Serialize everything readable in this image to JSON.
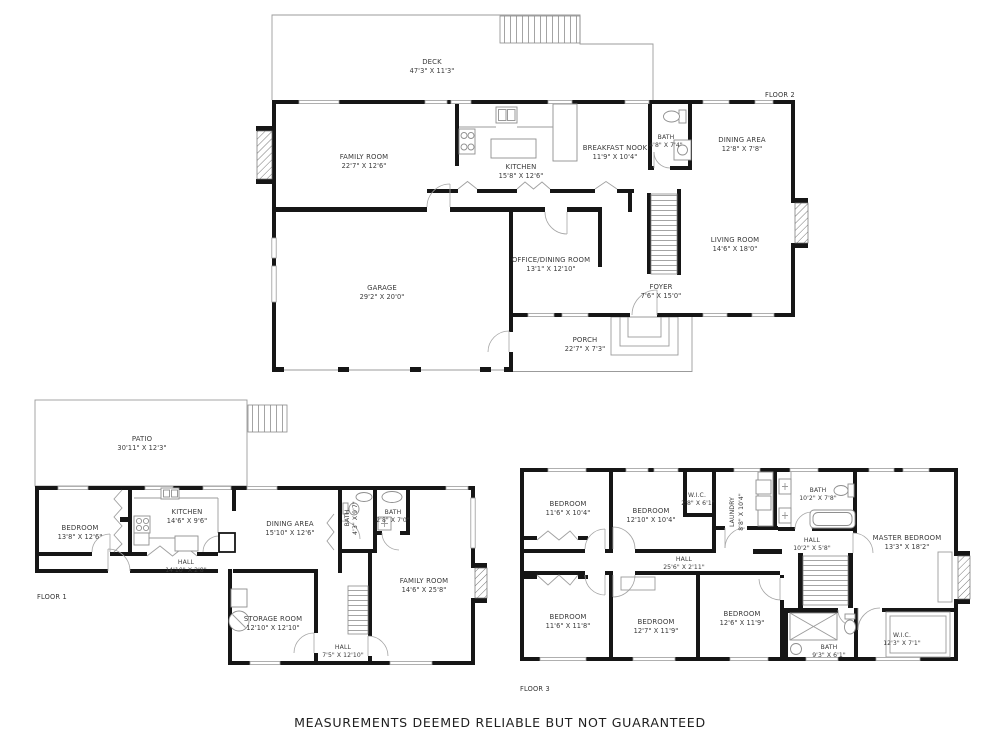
{
  "disclaimer": "MEASUREMENTS DEEMED RELIABLE BUT NOT GUARANTEED",
  "colors": {
    "background": "#ffffff",
    "wall": "#161616",
    "thin_line": "#9b9b9b",
    "label_text": "#3a3a3a",
    "disclaimer_text": "#1f1f1f"
  },
  "floors": {
    "floor2": {
      "label": "FLOOR 2",
      "rooms": [
        {
          "name": "DECK",
          "dims": "47'3\" X 11'3\""
        },
        {
          "name": "FAMILY ROOM",
          "dims": "22'7\" X 12'6\""
        },
        {
          "name": "KITCHEN",
          "dims": "15'8\" X 12'6\""
        },
        {
          "name": "BREAKFAST NOOK",
          "dims": "11'9\" X 10'4\""
        },
        {
          "name": "BATH",
          "dims": "4'8\" X 7'4\""
        },
        {
          "name": "DINING AREA",
          "dims": "12'8\" X 7'8\""
        },
        {
          "name": "LIVING ROOM",
          "dims": "14'6\" X 18'0\""
        },
        {
          "name": "OFFICE/DINING ROOM",
          "dims": "13'1\" X 12'10\""
        },
        {
          "name": "GARAGE",
          "dims": "29'2\" X 20'0\""
        },
        {
          "name": "FOYER",
          "dims": "7'6\" X 15'0\""
        },
        {
          "name": "PORCH",
          "dims": "22'7\" X 7'3\""
        }
      ]
    },
    "floor1": {
      "label": "FLOOR 1",
      "rooms": [
        {
          "name": "PATIO",
          "dims": "30'11\" X 12'3\""
        },
        {
          "name": "BEDROOM",
          "dims": "13'8\" X 12'6\""
        },
        {
          "name": "KITCHEN",
          "dims": "14'6\" X 9'6\""
        },
        {
          "name": "DINING AREA",
          "dims": "15'10\" X 12'6\""
        },
        {
          "name": "BATH",
          "dims": "4'3\" X 9'7\""
        },
        {
          "name": "BATH",
          "dims": "2'8\" X 7'0\""
        },
        {
          "name": "HALL",
          "dims": "14'10\" X 2'8\""
        },
        {
          "name": "STORAGE ROOM",
          "dims": "12'10\" X 12'10\""
        },
        {
          "name": "HALL",
          "dims": "7'5\" X 12'10\""
        },
        {
          "name": "FAMILY ROOM",
          "dims": "14'6\" X 25'8\""
        }
      ]
    },
    "floor3": {
      "label": "FLOOR 3",
      "rooms": [
        {
          "name": "BEDROOM",
          "dims": "11'6\" X 10'4\""
        },
        {
          "name": "BEDROOM",
          "dims": "12'10\" X 10'4\""
        },
        {
          "name": "W.I.C.",
          "dims": "2'8\" X 6'1\""
        },
        {
          "name": "LAUNDRY",
          "dims": "8'8\" X 10'4\""
        },
        {
          "name": "BATH",
          "dims": "10'2\" X 7'8\""
        },
        {
          "name": "HALL",
          "dims": "10'2\" X 5'8\""
        },
        {
          "name": "MASTER BEDROOM",
          "dims": "13'3\" X 18'2\""
        },
        {
          "name": "HALL",
          "dims": "25'6\" X 2'11\""
        },
        {
          "name": "BEDROOM",
          "dims": "11'6\" X 11'8\""
        },
        {
          "name": "BEDROOM",
          "dims": "12'7\" X 11'9\""
        },
        {
          "name": "BEDROOM",
          "dims": "12'6\" X 11'9\""
        },
        {
          "name": "BATH",
          "dims": "9'3\" X 6'1\""
        },
        {
          "name": "W.I.C.",
          "dims": "12'3\" X 7'1\""
        }
      ]
    }
  }
}
